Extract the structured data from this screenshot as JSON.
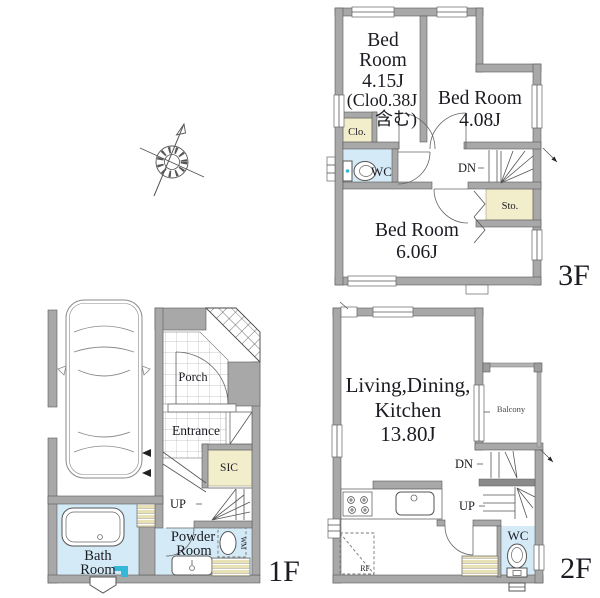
{
  "floor3": {
    "floor_label": "3F",
    "bedroom1": {
      "name_line1": "Bed",
      "name_line2": "Room",
      "size": "4.15J",
      "note_line1": "(Clo0.38J",
      "note_line2": "含む)"
    },
    "bedroom2": {
      "name": "Bed Room",
      "size": "4.08J"
    },
    "bedroom3": {
      "name": "Bed Room",
      "size": "6.06J"
    },
    "closet_label": "Clo.",
    "wc_label": "WC",
    "storage_label": "Sto.",
    "stairs_down_label": "DN"
  },
  "floor2": {
    "floor_label": "2F",
    "ldk": {
      "name_line1": "Living,Dining,",
      "name_line2": "Kitchen",
      "size": "13.80J"
    },
    "balcony_label": "Balcony",
    "wc_label": "WC",
    "refrigerator_label": "RF",
    "stairs_down_label": "DN",
    "stairs_up_label": "UP"
  },
  "floor1": {
    "floor_label": "1F",
    "porch_label": "Porch",
    "entrance_label": "Entrance",
    "sic_label": "SIC",
    "stairs_up_label": "UP",
    "powder_room": {
      "line1": "Powder",
      "line2": "Room"
    },
    "bath_room": {
      "line1": "Bath",
      "line2": "Room"
    },
    "washing_machine_label": "WM"
  },
  "colors": {
    "wall_gray": "#a8a8a8",
    "closet_beige": "#f2edcb",
    "water_blue": "#d4ebf7",
    "accent_cyan": "#35b7d7",
    "line_dark": "#555555",
    "text_dark": "#1b1b22"
  }
}
